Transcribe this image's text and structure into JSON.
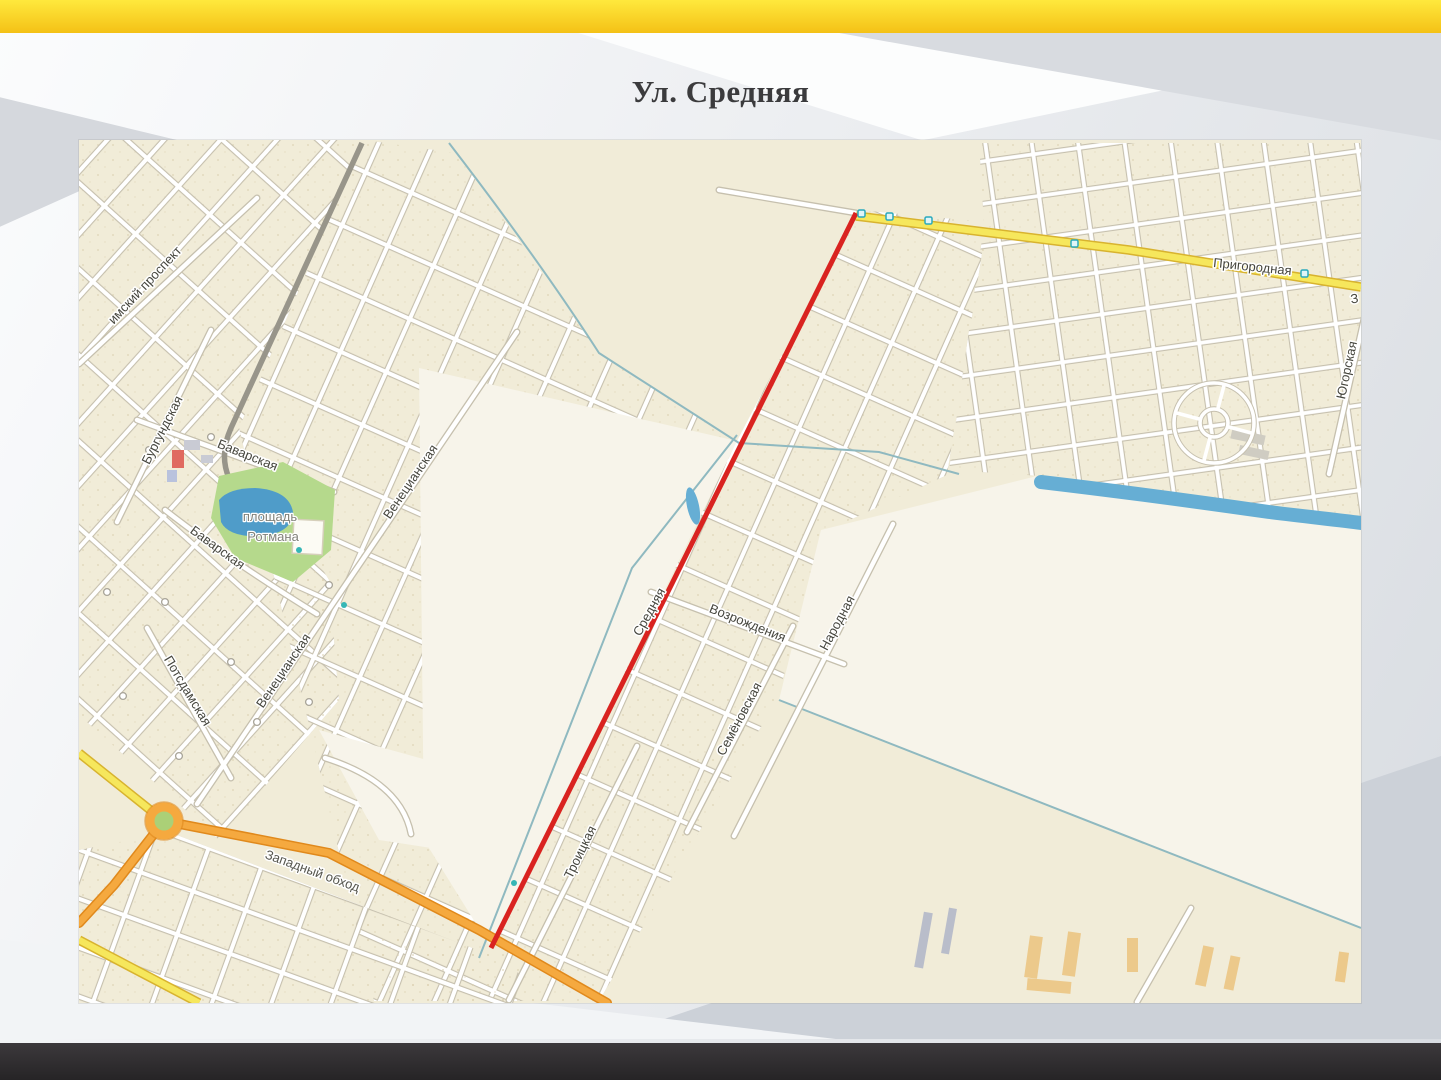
{
  "page": {
    "title": "Ул. Средняя"
  },
  "map": {
    "highlighted_street": "Средняя",
    "labels": [
      {
        "text": "имский проспект",
        "x": 69,
        "y": 148,
        "r": -47,
        "cls": "street"
      },
      {
        "text": "Бургундская",
        "x": 87,
        "y": 292,
        "r": -63,
        "cls": "street"
      },
      {
        "text": "Баварская",
        "x": 167,
        "y": 319,
        "r": 22,
        "cls": "street"
      },
      {
        "text": "Баварская",
        "x": 136,
        "y": 411,
        "r": 36,
        "cls": "street"
      },
      {
        "text": "площадь",
        "x": 191,
        "y": 381,
        "r": 0,
        "cls": "poi",
        "size": 15
      },
      {
        "text": "Ротмана",
        "x": 194,
        "y": 401,
        "r": 0,
        "cls": "poi",
        "size": 15
      },
      {
        "text": "Венецианская",
        "x": 335,
        "y": 344,
        "r": -56,
        "cls": "street"
      },
      {
        "text": "Венецианская",
        "x": 208,
        "y": 533,
        "r": -56,
        "cls": "street"
      },
      {
        "text": "Потсдамская",
        "x": 105,
        "y": 553,
        "r": 59,
        "cls": "street"
      },
      {
        "text": "Троицкая",
        "x": 505,
        "y": 714,
        "r": -64,
        "cls": "street"
      },
      {
        "text": "Средняя",
        "x": 574,
        "y": 474,
        "r": -61,
        "cls": "street"
      },
      {
        "text": "Возрождения",
        "x": 667,
        "y": 487,
        "r": 22,
        "cls": "street"
      },
      {
        "text": "Семёновская",
        "x": 664,
        "y": 581,
        "r": -62,
        "cls": "street"
      },
      {
        "text": "Народная",
        "x": 762,
        "y": 485,
        "r": -62,
        "cls": "street"
      },
      {
        "text": "Западный обход",
        "x": 232,
        "y": 735,
        "r": 20,
        "cls": "major",
        "size": 14
      },
      {
        "text": "Пригородная",
        "x": 1173,
        "y": 131,
        "r": 6,
        "cls": "street"
      },
      {
        "text": "Югорская",
        "x": 1272,
        "y": 231,
        "r": -78,
        "cls": "street"
      },
      {
        "text": "З",
        "x": 1276,
        "y": 163,
        "r": -8,
        "cls": "street"
      }
    ],
    "colors": {
      "route_red": "#d92320",
      "road_yellow": "#f6e75c",
      "road_yellow_casing": "#d8b32f",
      "road_orange": "#f5a93f",
      "road_orange_casing": "#e0891c",
      "street_casing": "#c6c0ae",
      "gray_road": "#98958a",
      "map_base": "#f1ecd8",
      "field_light": "#f7f4ea",
      "park_green": "#b5d98c",
      "pond_blue": "#4f9cc9",
      "water_blue": "#66aed4",
      "boundary_teal": "#8fb9c0",
      "top_bar_from": "#ffe93d",
      "top_bar_to": "#f4c116",
      "bottom_bar": "#2d2b2d",
      "title_color": "#3b3b3d"
    }
  }
}
